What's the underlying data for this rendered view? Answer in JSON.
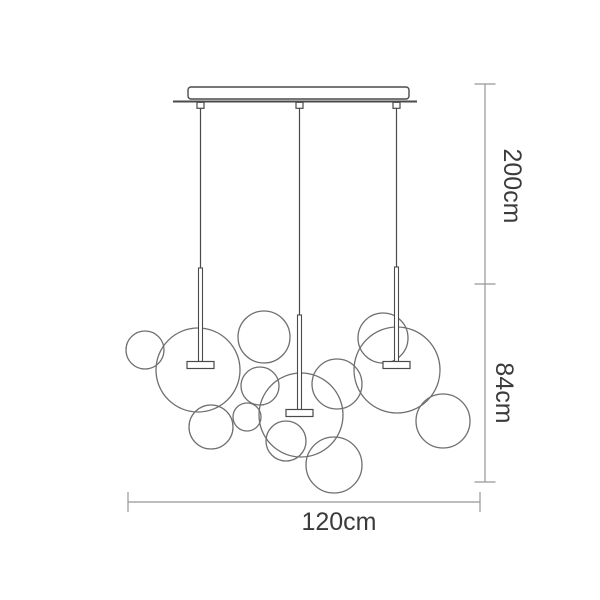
{
  "labels": {
    "drop_height": "200cm",
    "fixture_height": "84cm",
    "width": "120cm"
  },
  "colors": {
    "background": "#ffffff",
    "bubble_outline": "#6f6f6f",
    "hardware": "#4a4a4a",
    "dimension_line": "#969696",
    "label_text": "#3b3b3b",
    "fill": "#ffffff"
  },
  "diagram": {
    "type": "product-dimension-diagram",
    "subject": "bubble glass pendant chandelier",
    "canopy": {
      "plate": {
        "x": 188,
        "y": 87,
        "w": 221,
        "h": 12,
        "rx": 3
      },
      "baseline": {
        "x1": 173,
        "x2": 417,
        "y": 101.5
      },
      "hanger_w": 7,
      "hanger_h": 6
    },
    "rod_width": 4,
    "disc": {
      "w": 27,
      "h": 7
    },
    "pendants": [
      {
        "x": 200.5,
        "cable_top": 108,
        "rod_top": 268,
        "disc_y": 361.5
      },
      {
        "x": 299.5,
        "cable_top": 108,
        "rod_top": 315,
        "disc_y": 409.5
      },
      {
        "x": 396.5,
        "cable_top": 108,
        "rod_top": 267,
        "disc_y": 361.5
      }
    ],
    "bubbles": [
      {
        "cx": 145,
        "cy": 350,
        "r": 19
      },
      {
        "cx": 198,
        "cy": 370,
        "r": 42
      },
      {
        "cx": 264,
        "cy": 337,
        "r": 26
      },
      {
        "cx": 260,
        "cy": 386,
        "r": 19
      },
      {
        "cx": 247,
        "cy": 417,
        "r": 14
      },
      {
        "cx": 211,
        "cy": 427,
        "r": 22
      },
      {
        "cx": 301,
        "cy": 415,
        "r": 42
      },
      {
        "cx": 286,
        "cy": 441,
        "r": 20
      },
      {
        "cx": 334,
        "cy": 465,
        "r": 28
      },
      {
        "cx": 337,
        "cy": 384,
        "r": 25
      },
      {
        "cx": 383,
        "cy": 338,
        "r": 25
      },
      {
        "cx": 397,
        "cy": 370,
        "r": 43
      },
      {
        "cx": 443,
        "cy": 421,
        "r": 27
      }
    ],
    "dimensions": {
      "vertical": {
        "x": 485,
        "cap_half": 10.5,
        "stops": [
          84,
          284,
          482
        ],
        "labels": [
          {
            "key": "drop_height",
            "cx": 512,
            "cy": 186
          },
          {
            "key": "fixture_height",
            "cx": 504,
            "cy": 393
          }
        ]
      },
      "horizontal": {
        "y": 502,
        "x1": 128,
        "x2": 480,
        "cap_half": 10,
        "label": {
          "cx": 339,
          "y": 530
        }
      }
    }
  }
}
